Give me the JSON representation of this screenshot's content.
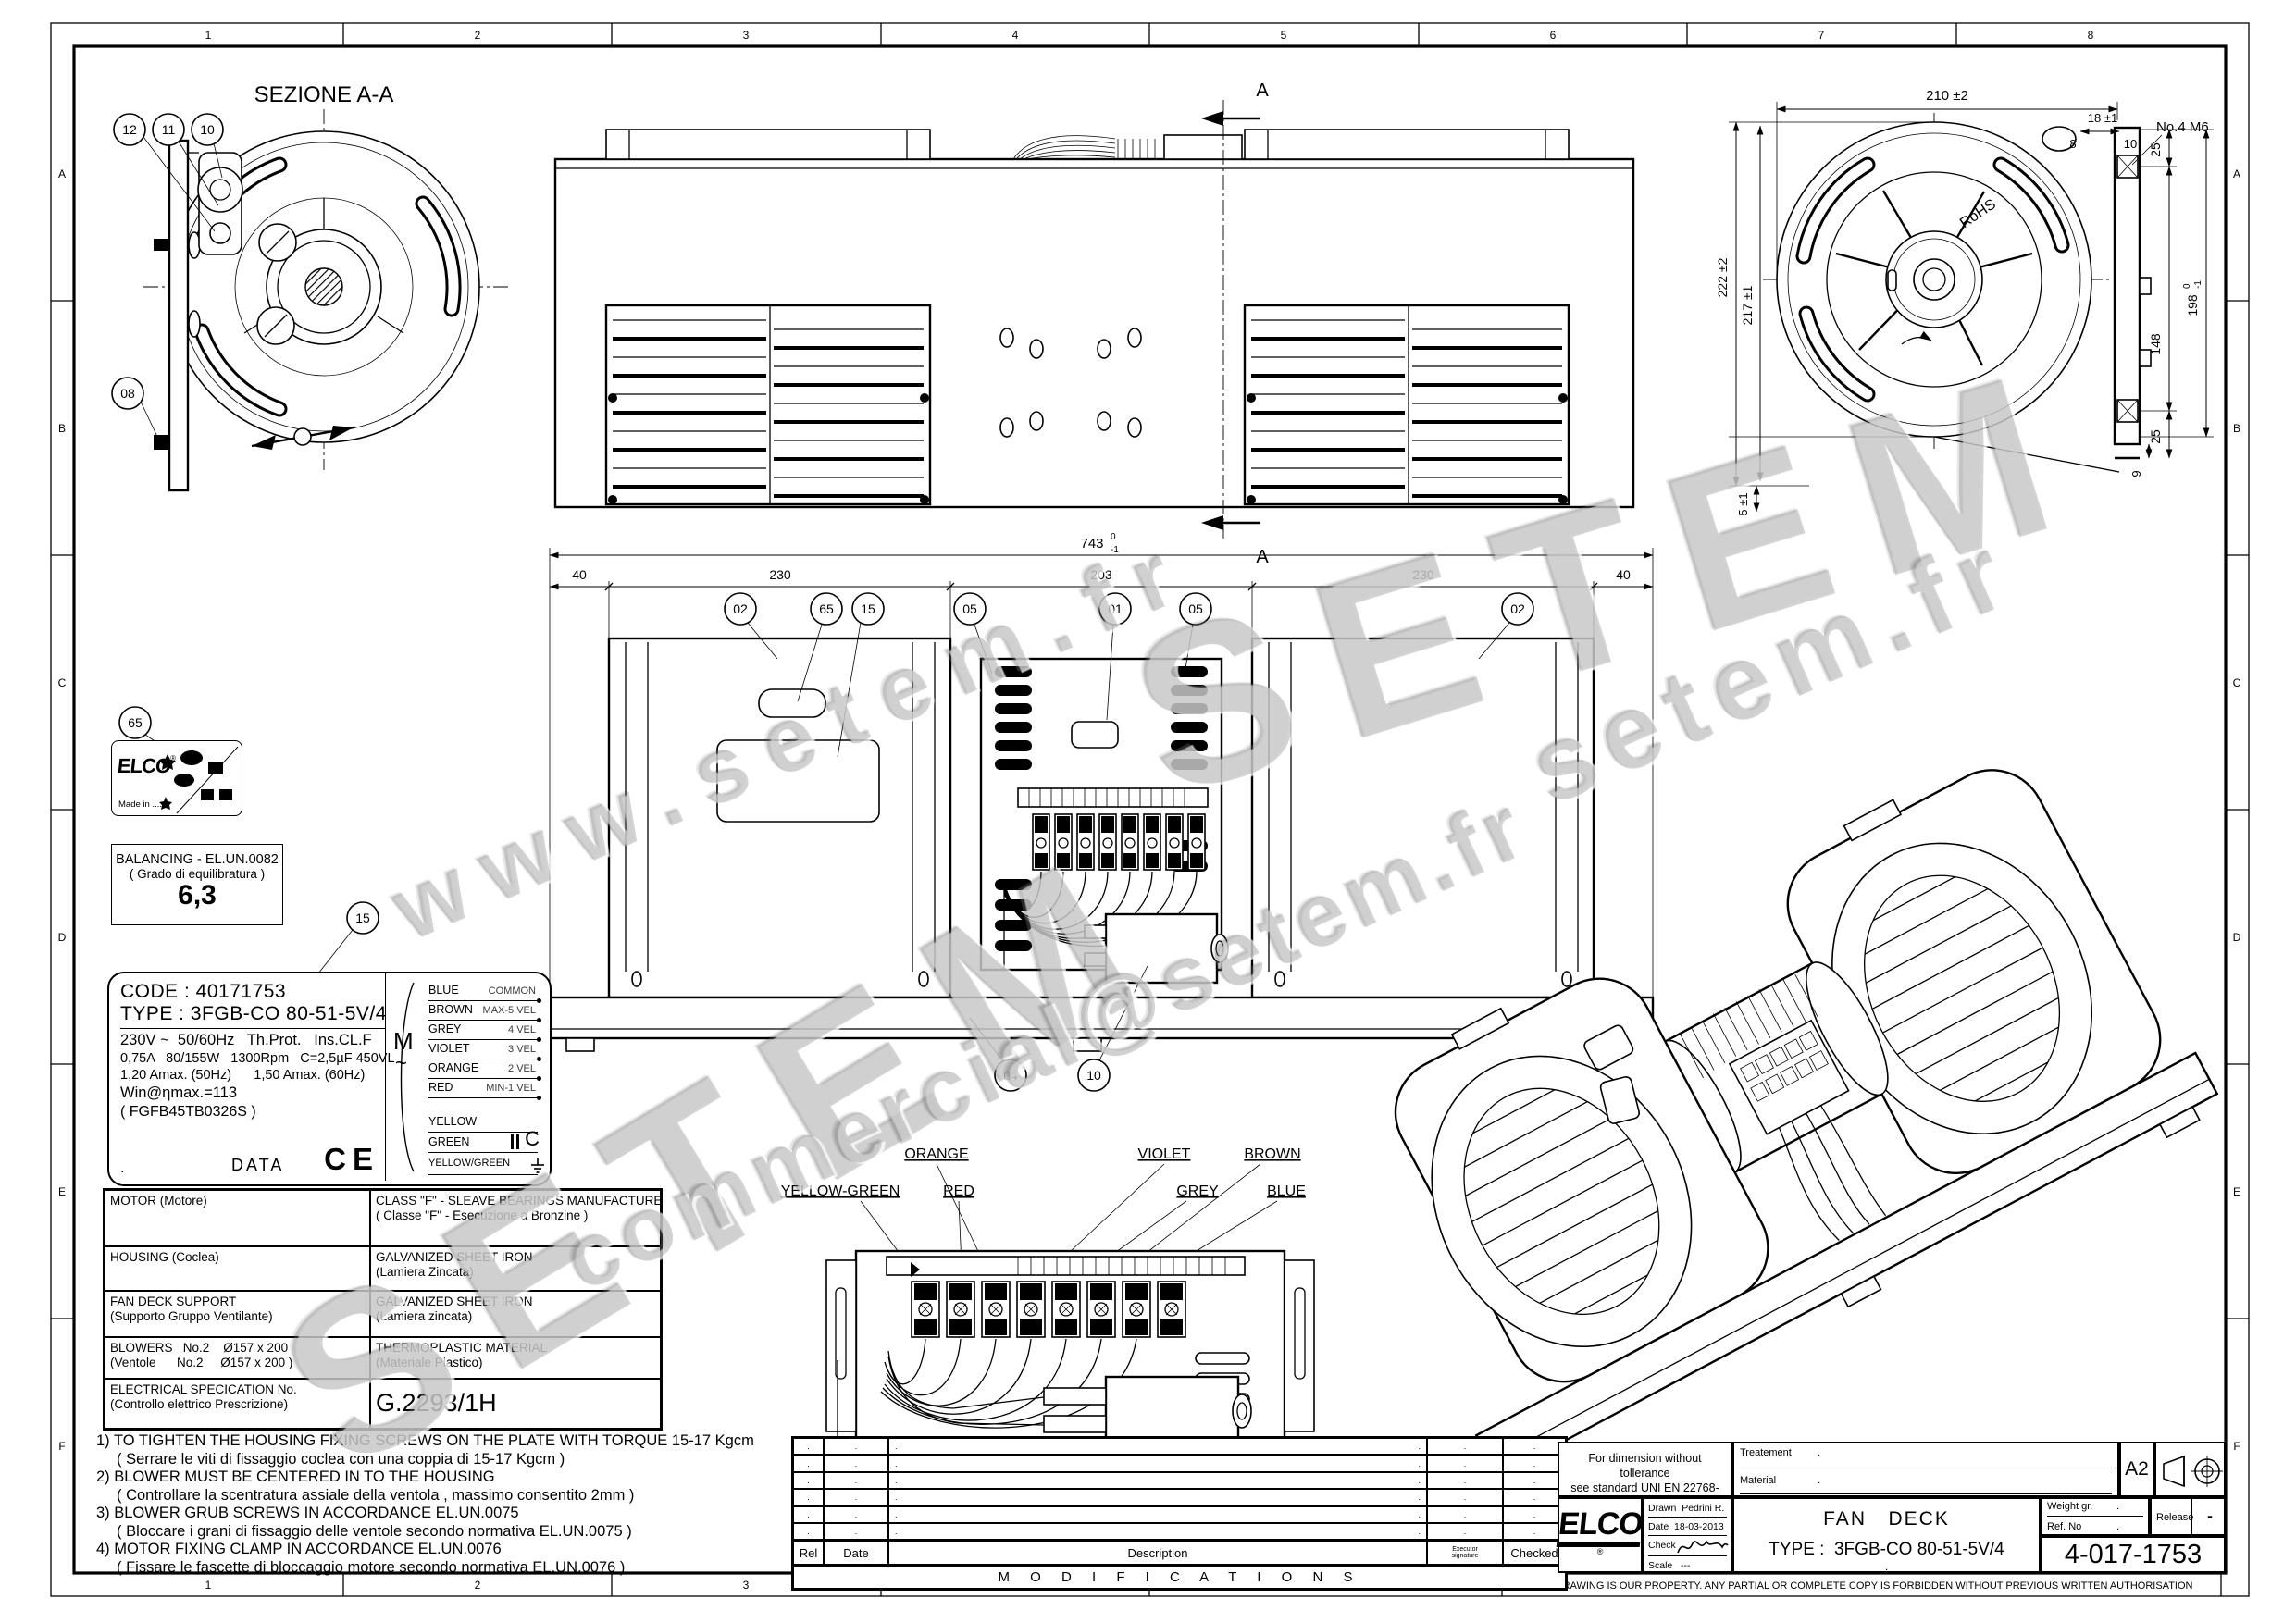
{
  "frame": {
    "columns": [
      "1",
      "2",
      "3",
      "4",
      "5",
      "6",
      "7",
      "8"
    ],
    "rows": [
      "A",
      "B",
      "C",
      "D",
      "E",
      "F"
    ],
    "bottom_note_cad": "DRAWING MADE BY CAD HAND MADE MODIFICATIONS ARE FORBIDDEN",
    "bottom_note_property": "THIS DRAWING IS OUR PROPERTY. ANY PARTIAL OR COMPLETE COPY IS FORBIDDEN WITHOUT PREVIOUS WRITTEN AUTHORISATION"
  },
  "watermarks": [
    "www.setem.fr",
    "SETEM",
    "SETEM",
    "setem.fr",
    "commercial@setem.fr"
  ],
  "section_view": {
    "title": "SEZIONE A-A",
    "balloons": [
      "12",
      "11",
      "10",
      "08"
    ]
  },
  "plan_view": {
    "section_letter": "A"
  },
  "end_view": {
    "wheel_text": "RoHS",
    "dims": {
      "w": "210 ±2",
      "d18": "18 ±1",
      "d8": "8",
      "d10": "10",
      "holes": "No.4  M6",
      "d25t": "25",
      "d148": "148",
      "d198": "198",
      "d198_tol_top": "0",
      "d198_tol_bot": "-1",
      "d25b": "25",
      "d9": "9",
      "d5": "5 ±1",
      "d222": "222 ±2",
      "d217": "217 ±1"
    }
  },
  "front_view": {
    "dim_total": "743",
    "dim_total_tol_top": "0",
    "dim_total_tol_bot": "-1",
    "dims": [
      "40",
      "230",
      "203",
      "230",
      "40"
    ],
    "balloons_top": [
      "02",
      "65",
      "15",
      "05",
      "01",
      "05",
      "02"
    ],
    "balloons_bottom": [
      "04",
      "10"
    ]
  },
  "labels": {
    "elco_label": {
      "balloon": "65",
      "brand": "ELCO",
      "reg": "®",
      "made_in": "Made in ....."
    },
    "balancing": {
      "line1": "BALANCING - EL.UN.0082",
      "line2": "( Grado di equilibratura )",
      "value": "6,3"
    },
    "plate_balloon": "15"
  },
  "data_plate": {
    "code": "CODE : 40171753",
    "type": "TYPE : 3FGB-CO 80-51-5V/4",
    "line1": "230V ~  50/60Hz   Th.Prot.   Ins.CL.F",
    "line2": "0,75A   80/155W   1300Rpm   C=2,5µF 450VL",
    "line3": "1,20 Amax. (50Hz)      1,50 Amax. (60Hz)",
    "line4": "Win@ηmax.=113",
    "line5": "( FGFB45TB0326S )",
    "dot": ".",
    "data_label": "DATA",
    "ce": "CE",
    "motor_symbol": "M",
    "motor_tilde": "~",
    "wiring": [
      {
        "color": "BLUE",
        "function": "COMMON"
      },
      {
        "color": "BROWN",
        "function": "MAX-5 VEL"
      },
      {
        "color": "GREY",
        "function": "4 VEL"
      },
      {
        "color": "VIOLET",
        "function": "3 VEL"
      },
      {
        "color": "ORANGE",
        "function": "2 VEL"
      },
      {
        "color": "RED",
        "function": "MIN-1 VEL"
      },
      {
        "color": "YELLOW",
        "function": ""
      },
      {
        "color": "GREEN",
        "function": "C"
      },
      {
        "color": "YELLOW/GREEN",
        "function": ""
      }
    ]
  },
  "materials": {
    "rows": [
      {
        "l1": "MOTOR (Motore)",
        "l2": "",
        "r1": "CLASS \"F\" - SLEAVE BEARINGS MANUFACTURED",
        "r2": "( Classe \"F\" - Esecuzione a Bronzine )"
      },
      {
        "l1": "HOUSING (Coclea)",
        "l2": "",
        "r1": "GALVANIZED SHEET IRON",
        "r2": "(Lamiera Zincata)"
      },
      {
        "l1": "FAN DECK SUPPORT",
        "l2": "(Supporto Gruppo Ventilante)",
        "r1": "GALVANIZED SHEET IRON",
        "r2": "(Lamiera zincata)"
      },
      {
        "l1": "BLOWERS   No.2    Ø157 x 200",
        "l2": "(Ventole      No.2     Ø157 x 200 )",
        "r1": "THERMOPLASTIC MATERIAL",
        "r2": "(Materiale Plastico)"
      },
      {
        "l1": "ELECTRICAL SPECICATION No.",
        "l2": "(Controllo elettrico Prescrizione)",
        "r1": "G.2293/1H",
        "r2": ""
      }
    ]
  },
  "notes": [
    "1) TO TIGHTEN THE HOUSING FIXING SCREWS ON THE PLATE WITH TORQUE 15-17 Kgcm",
    "( Serrare le viti di fissaggio coclea con una coppia di 15-17 Kgcm )",
    "2) BLOWER MUST BE CENTERED IN TO THE HOUSING",
    "( Controllare la scentratura assiale della ventola , massimo consentito 2mm )",
    "3) BLOWER GRUB SCREWS IN ACCORDANCE EL.UN.0075",
    "( Bloccare i grani di fissaggio delle ventole secondo normativa EL.UN.0075 )",
    "4) MOTOR FIXING CLAMP IN ACCORDANCE EL.UN.0076",
    "( Fissare le fascette di bloccaggio motore secondo normativa EL.UN.0076 )"
  ],
  "wiring_detail": {
    "row1": [
      "ORANGE",
      "VIOLET",
      "BROWN"
    ],
    "row2": [
      "YELLOW-GREEN",
      "RED",
      "GREY",
      "BLUE"
    ]
  },
  "modifications": {
    "title": "M O D I F I C A T I O N S",
    "rel": "Rel",
    "date": "Date",
    "description": "Description",
    "exec1": "Executor",
    "exec2": "signature",
    "checked": "Checked",
    "placeholder": "."
  },
  "title_block": {
    "tolerance_line1": "For dimension without tollerance",
    "tolerance_line2": "see standard UNI EN 22768-mK",
    "treatement_label": "Treatement",
    "treatement_value": ".",
    "material_label": "Material",
    "material_value": ".",
    "format": "A2",
    "logo": "ELCO",
    "logo_reg": "®",
    "drawn_label": "Drawn",
    "drawn": "Pedrini R.",
    "date_label": "Date",
    "date": "18-03-2013",
    "check_label": "Check",
    "scale_label": "Scale",
    "scale": "---",
    "title": "FAN   DECK",
    "type_line": "TYPE :  3FGB-CO 80-51-5V/4",
    "center_dot": ".",
    "weight_label": "Weight gr.",
    "weight_value": ".",
    "ref_label": "Ref. No",
    "ref_value": ".",
    "release_label": "Release",
    "release_value": "-",
    "drawing_number": "4-017-1753"
  }
}
